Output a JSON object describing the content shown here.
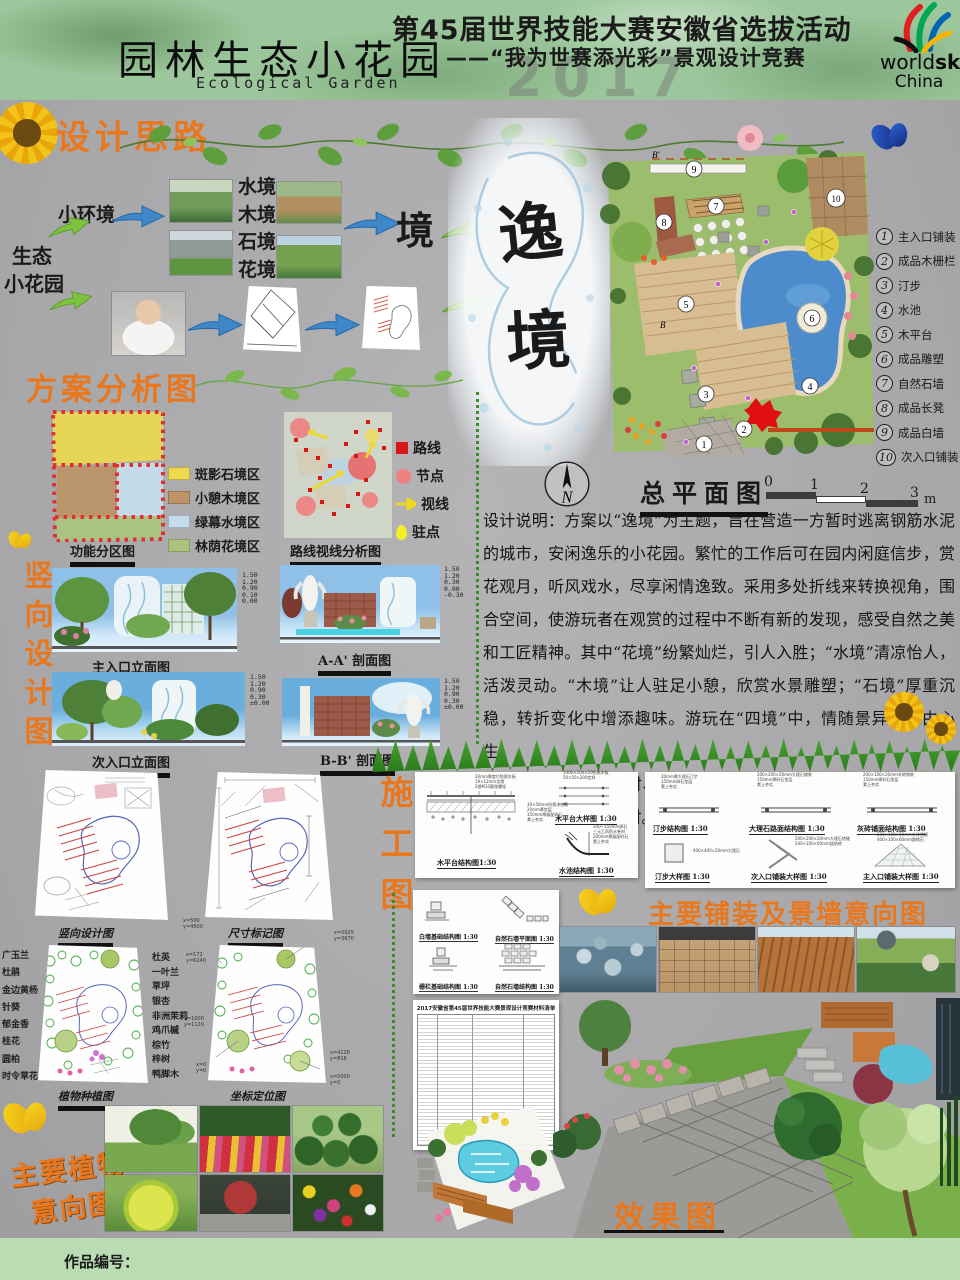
{
  "header": {
    "title_cn": "园林生态小花园",
    "title_en": "Ecological Garden",
    "event_line1": "第45届世界技能大赛安徽省选拔活动",
    "event_line2": "——“我为世赛添光彩”景观设计竞赛",
    "watermark": "2017",
    "logo_world": "world",
    "logo_skills": "skills",
    "logo_china": "China"
  },
  "thinking": {
    "title": "设计思路",
    "eco": "生态",
    "garden": "小花园",
    "small_env": "小环境",
    "envs": [
      "水境",
      "木境",
      "石境",
      "花境"
    ],
    "jing": "境",
    "theme1": "逸",
    "theme2": "境"
  },
  "site": {
    "b_top": "B'",
    "b_mid": "B",
    "nums": [
      "1",
      "2",
      "3",
      "4",
      "5",
      "6",
      "7",
      "8",
      "9",
      "10"
    ],
    "legend": [
      {
        "num": "1",
        "label": "主入口铺装"
      },
      {
        "num": "2",
        "label": "成品木栅栏"
      },
      {
        "num": "3",
        "label": "汀步"
      },
      {
        "num": "4",
        "label": "水池"
      },
      {
        "num": "5",
        "label": "木平台"
      },
      {
        "num": "6",
        "label": "成品雕塑"
      },
      {
        "num": "7",
        "label": "自然石墙"
      },
      {
        "num": "8",
        "label": "成品长凳"
      },
      {
        "num": "9",
        "label": "成品白墙"
      },
      {
        "num": "10",
        "label": "次入口铺装"
      }
    ],
    "master_title": "总平面图",
    "compass_letter": "N",
    "scale_ticks": [
      "0",
      "1",
      "2",
      "3"
    ],
    "scale_unit": "m"
  },
  "analysis": {
    "title": "方案分析图",
    "zones_caption": "功能分区图",
    "zones_legend": [
      {
        "label": "斑影石境区",
        "color": "#ecd94e"
      },
      {
        "label": "小憩木境区",
        "color": "#bc9468"
      },
      {
        "label": "绿幕水境区",
        "color": "#c6dcec"
      },
      {
        "label": "林荫花境区",
        "color": "#aac47e"
      }
    ],
    "route_caption": "路线视线分析图",
    "route_legend": [
      {
        "label": "路线"
      },
      {
        "label": "节点"
      },
      {
        "label": "视线"
      },
      {
        "label": "驻点"
      }
    ]
  },
  "desc": {
    "p1": "设计说明：方案以“逸境”为主题，旨在营造一方暂时逃离钢筋水泥的城市，安闲逸乐的小花园。繁忙的工作后可在园内闲庭信步，赏花观月，听风戏水，尽享闲情逸致。采用多处折线来转换视角，围合空间，使游玩者在观赏的过程中不断有新的发现，感受自然之美和工匠精神。其中“花境”纷繁灿烂，引人入胜；“水境”清凉怡人，活泼灵动。“木境”让人驻足小憩，欣赏水景雕塑；“石境”厚重沉稳，转折变化中增添趣味。游玩在“四境”中，情随景异，意由心生。",
    "p2": "预计工时：木作5小时、砌筑4小时、水景6小时、铺装4小时、种植3小时，共计22小时。"
  },
  "vert": {
    "title": "竖向设计图",
    "caps": [
      "主入口立面图",
      "A-A' 剖面图",
      "次入口立面图",
      "B-B' 剖面图"
    ],
    "t1": "1.50\n1.20\n0.90\n0.10\n0.00",
    "t2": "1.50\n1.20\n0.30\n0.00\n-0.30",
    "t3": "1.50\n1.20\n0.90\n0.30\n±0.00",
    "t4": "1.50\n1.20\n0.90\n0.30\n±0.00"
  },
  "cons": {
    "title": "施工图",
    "caps": [
      "竖向设计图",
      "尺寸标记图",
      "植物种植图",
      "坐标定位图"
    ],
    "plants_left": [
      "广玉兰",
      "杜鹃",
      "金边黄杨",
      "针葵",
      "郁金香",
      "桂花",
      "圆柏",
      "时令草花"
    ],
    "plants_right": [
      "杜英",
      "一叶兰",
      "草坪",
      "银杏",
      "非洲茉莉",
      "鸡爪槭",
      "棕竹",
      "梓树",
      "鸭脚木"
    ],
    "c1": "x=500\ny=4500",
    "c2": "x=5025\ny=3670",
    "c3": "x=172\ny=6240",
    "c4": "x=1000\ny=1120",
    "c5": "x=4126\ny=818",
    "c6": "x=0\ny=0",
    "c7": "x=5000\ny=0",
    "p1cap1": "木平台结构图1:30",
    "p1cap2": "木平台大样图 1:30",
    "p1cap3": "水池结构图 1:30",
    "p1n1": "30×50mm防腐木龙骨\n20mm厚垫层\n150mm厚级配碎石\n素土夯实",
    "p1n2": "20mm厚度竹防腐木板\n19×12mm龙骨\n2根M10膨胀螺栓",
    "p1n3": "1400×200×20防腐木板\n50×50×200定样",
    "p1n4": "100~150mm卵石\n三元乙丙防水卷材\n200mm厚级配砂石\n素土夯实",
    "p2cap1": "汀步结构图 1:30",
    "p2cap2": "大理石路面结构图 1:30",
    "p2cap3": "灰砖铺面结构图 1:30",
    "p2cap4": "汀步大样图 1:30",
    "p2cap5": "次入口铺装大样图 1:30",
    "p2cap6": "主入口铺装大样图 1:30",
    "p2n1": "20mm厚大理石汀步\n150mm碎石垫层\n素土夯实",
    "p2n2": "200×200×20mm大理石铺装\n150mm厚砂石垫层\n素土夯实",
    "p2n3": "200×100×20mm灰砖铺装\n150mm厚砂石垫层\n素土夯实",
    "p2n4": "400×400×20mm大理石",
    "p2n5": "200×200×20mm大理石错缝\n240×100×60mm烧结砖",
    "p2n6": "200×100×50mm灰砖错缝\n400×100×60mm路缘石",
    "p3cap1": "白墙基础结构图 1:30",
    "p3cap2": "自然石墙平面图 1:30",
    "p3cap3": "栅栏基础结构图 1:30",
    "p3cap4": "自然石墙结构图 1:30",
    "table_title": "2017安徽省第45届世界技能大赛景观设计竞赛材料清单"
  },
  "paving": {
    "title": "主要铺装及景墙意向图"
  },
  "plants": {
    "l1": "主要植物",
    "l2": "意向图"
  },
  "effect": {
    "title": "效果图"
  },
  "footer": {
    "label": "作品编号："
  }
}
